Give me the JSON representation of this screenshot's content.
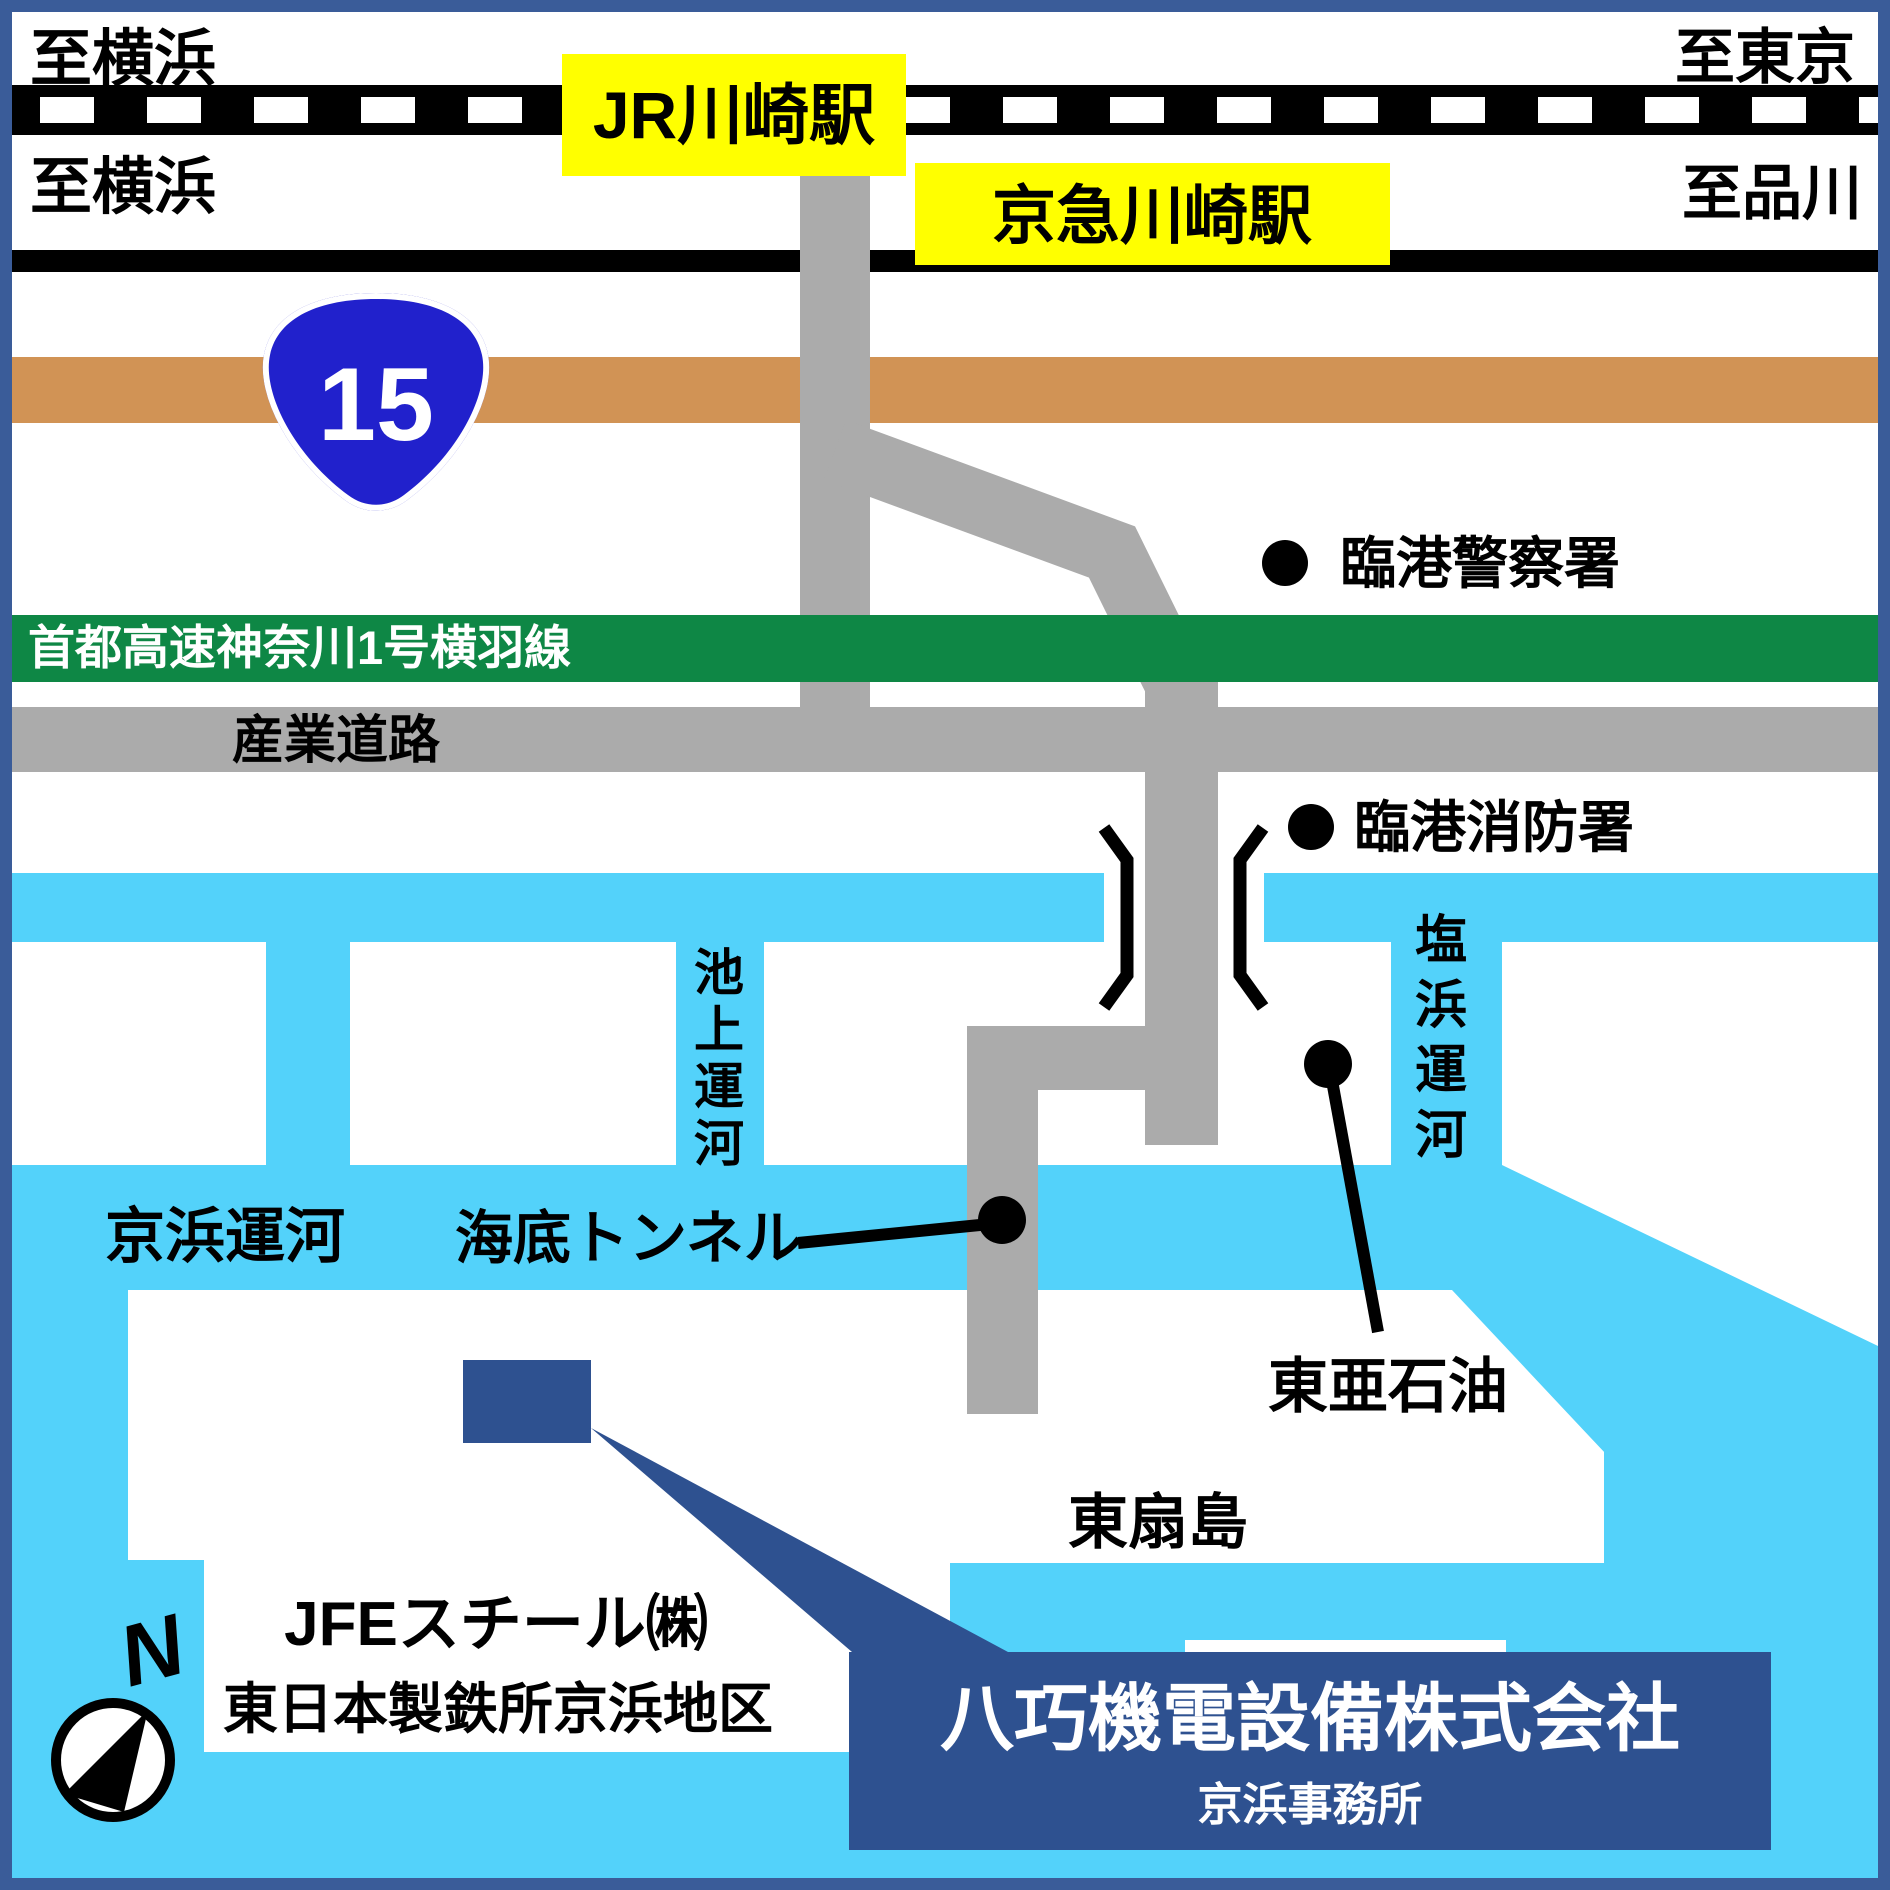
{
  "colors": {
    "border": "#3a5c99",
    "water": "#53d2fa",
    "road_gray": "#ababab",
    "expressway_green": "#0e8745",
    "route15_orange": "#d19355",
    "route15_blue": "#2121cc",
    "station_yellow": "#ffff00",
    "company_blue": "#2e5190",
    "rail_black": "#000000"
  },
  "header": {
    "to_yokohama_jr": "至横浜",
    "to_tokyo": "至東京",
    "jr_station": "JR川崎駅",
    "to_yokohama_keikyu": "至横浜",
    "to_shinagawa": "至品川",
    "keikyu_station": "京急川崎駅"
  },
  "roads": {
    "route15_number": "15",
    "expressway": "首都高速神奈川1号横羽線",
    "sangyo_road": "産業道路"
  },
  "pois": {
    "police": "臨港警察署",
    "fire": "臨港消防署",
    "undersea_tunnel": "海底トンネル",
    "toa_oil": "東亜石油",
    "higashi_ogishima": "東扇島",
    "jfe_line1": "JFEスチール㈱",
    "jfe_line2": "東日本製鉄所京浜地区"
  },
  "canals": {
    "keihin": "京浜運河",
    "ikegami_chars": [
      "池",
      "上",
      "運",
      "河"
    ],
    "shiohama_chars": [
      "塩",
      "浜",
      "運",
      "河"
    ]
  },
  "company": {
    "name": "八巧機電設備株式会社",
    "office": "京浜事務所"
  },
  "compass": {
    "north": "N"
  }
}
